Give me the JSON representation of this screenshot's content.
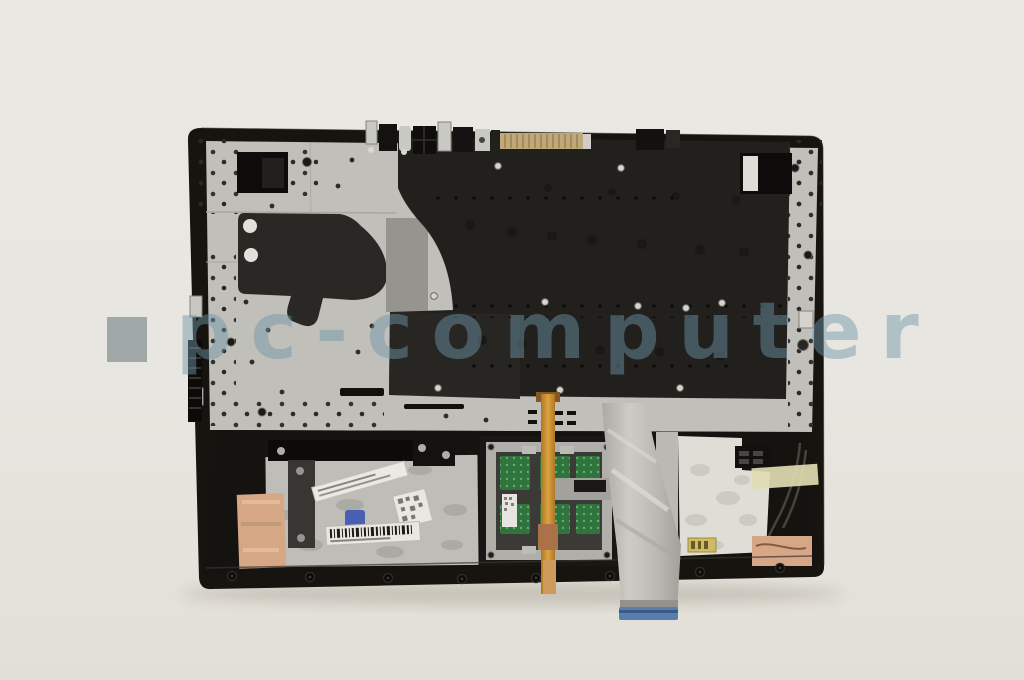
{
  "page": {
    "kind": "product-photo",
    "background_top": "#f4f2ee",
    "background_bottom": "#ebe8e0"
  },
  "watermark": {
    "text": "pc-computer"
  },
  "subject": {
    "title": "laptop palmrest / keyboard assembly, underside view",
    "parts": {
      "frame": "black top-case frame",
      "backplate": "silver aluminum support plate with screw holes",
      "keyboard_shield": "black keyboard shield plate",
      "mylar_sticker": "black insulation sticker with two punched holes",
      "docking_connector": "gold pin connector on top edge",
      "hinge_mount_left": "left hinge mount cutout",
      "hinge_mount_right": "right hinge mount cutout",
      "touchpad_module": "touchpad board with green PCB windows",
      "orange_flex_cable": "orange keyboard flex cable",
      "ribbon_cable": "grey touchpad ribbon cable",
      "ribbon_connector": "blue connector end of ribbon cable",
      "diagonal_label": "white part label, text not legible",
      "barcode_label": "white barcode label, text not legible",
      "qr_sticker": "small white QR sticker",
      "blue_component": "small blue clip",
      "copper_tape_left": "copper shielding tape",
      "copper_pad_right": "copper shielding pad",
      "kapton_tape": "pale yellow tape strip",
      "antenna_cables": "grey antenna cables",
      "battery_pocket": "white liner pocket",
      "gold_label": "small gold label"
    }
  },
  "palette": {
    "metal_silver": "#c8c7c2",
    "shield_black": "#23211e",
    "frame_black": "#17140f",
    "copper": "#dfae8a",
    "ribbon_grey": "#c6c4bf",
    "connector_blue": "#5a83b8",
    "pcb_green": "#2e7a3e",
    "kapton_yellow": "#e8e5ba",
    "gold_connector": "#c8b07c",
    "watermark_blue": "#6e96aa"
  }
}
